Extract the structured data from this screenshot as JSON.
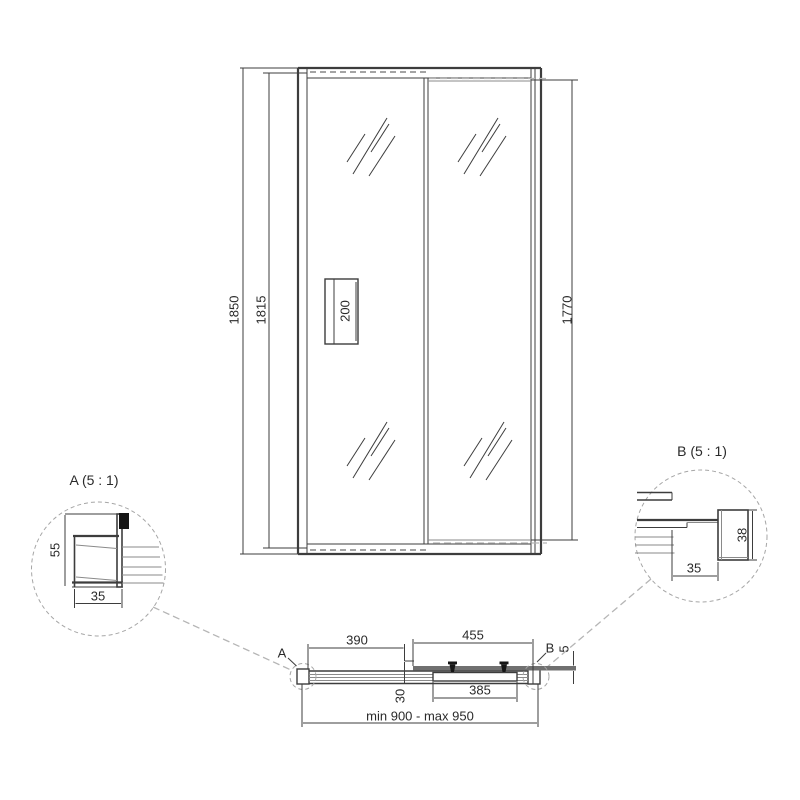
{
  "front_view": {
    "dim_total_height": "1850",
    "dim_door_height": "1815",
    "dim_glass_height": "1770",
    "dim_handle_height": "200"
  },
  "detail_a": {
    "title": "A (5 : 1)",
    "dim_profile_height": "55",
    "dim_profile_width": "35"
  },
  "detail_b": {
    "title": "B (5 : 1)",
    "dim_profile_height": "38",
    "dim_profile_width": "35"
  },
  "plan_view": {
    "marker_a": "A",
    "marker_b": "B",
    "dim_door_opening": "390",
    "dim_fixed_panel": "455",
    "dim_overlap": "30",
    "dim_door_width": "385",
    "dim_glass_thickness": "5",
    "dim_width_range": "min 900 - max 950"
  },
  "colors": {
    "line": "#3d3d3d",
    "panel_gray": "#707070",
    "dash_light": "#b5b5b5"
  }
}
